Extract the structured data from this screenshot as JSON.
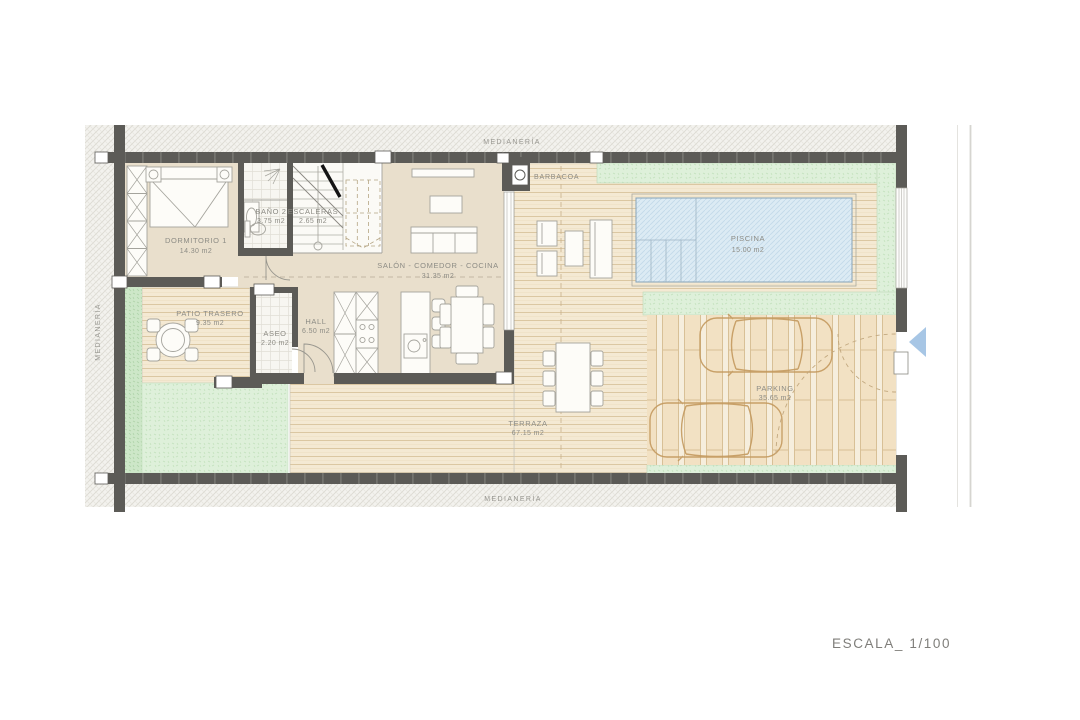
{
  "title": {
    "scale": "ESCALA_ 1/100"
  },
  "boundary": {
    "top": "MEDIANERÍA",
    "left": "MEDIANERÍA",
    "bottom": "MEDIANERÍA"
  },
  "rooms": {
    "dormitorio": {
      "name": "DORMITORIO 1",
      "area": "14.30 m2"
    },
    "bano": {
      "name": "BAÑO 2",
      "area": "3.75 m2"
    },
    "escaleras": {
      "name": "ESCALERAS",
      "area": "2.65 m2"
    },
    "salon": {
      "name": "SALÓN - COMEDOR - COCINA",
      "area": "31.35 m2"
    },
    "patio": {
      "name": "PATIO TRASERO",
      "area": "9.35 m2"
    },
    "aseo": {
      "name": "ASEO",
      "area": "2.20 m2"
    },
    "hall": {
      "name": "HALL",
      "area": "6.50 m2"
    },
    "terraza": {
      "name": "TERRAZA",
      "area": "67.15 m2"
    },
    "piscina": {
      "name": "PISCINA",
      "area": "15.00 m2"
    },
    "parking": {
      "name": "PARKING",
      "area": "35.65 m2"
    }
  },
  "features": {
    "barbacoa": "BARBACOA"
  },
  "colors": {
    "wall": "#5c5b57",
    "indoor_floor": "#e9dfcc",
    "deck": "#f4e9d3",
    "grass": "#def0da",
    "pool": "#dcebf4",
    "entrance_arrow": "#a7c6e5",
    "label_text": "#8d8c85"
  }
}
